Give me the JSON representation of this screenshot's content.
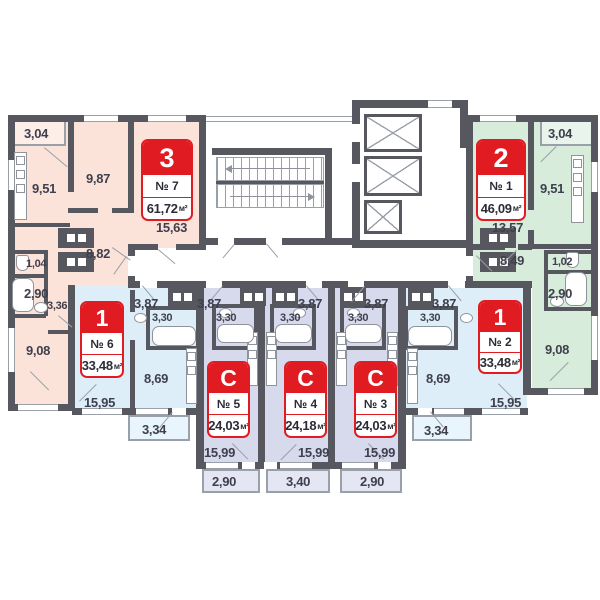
{
  "apartments": {
    "a7": {
      "type": "3",
      "num": "№ 7",
      "area": "61,72",
      "unit": "м²",
      "rooms": {
        "balcony": "3,04",
        "kitchen": "9,51",
        "bed": "9,87",
        "living": "15,63",
        "hall": "8,82",
        "wc": "1,04",
        "bath": "2,90",
        "corr": "3,36",
        "room": "9,08"
      }
    },
    "a6": {
      "type": "1",
      "num": "№ 6",
      "area": "33,48",
      "unit": "м²",
      "rooms": {
        "hall": "3,87",
        "bath": "3,30",
        "kitchen": "8,69",
        "living": "15,95",
        "balcony": "3,34"
      }
    },
    "a5": {
      "type": "С",
      "num": "№ 5",
      "area": "24,03",
      "unit": "м²",
      "rooms": {
        "hall": "3,87",
        "bath": "3,30",
        "living": "15,99",
        "balcony": "2,90"
      }
    },
    "a4": {
      "type": "С",
      "num": "№ 4",
      "area": "24,18",
      "unit": "м²",
      "rooms": {
        "hall": "3,87",
        "bath": "3,30",
        "living": "15,99",
        "balcony": "3,40"
      }
    },
    "a3": {
      "type": "С",
      "num": "№ 3",
      "area": "24,03",
      "unit": "м²",
      "rooms": {
        "hall": "3,87",
        "bath": "3,30",
        "living": "15,99",
        "balcony": "2,90"
      }
    },
    "a2": {
      "type": "1",
      "num": "№ 2",
      "area": "33,48",
      "unit": "м²",
      "rooms": {
        "hall": "3,87",
        "bath": "3,30",
        "kitchen": "8,69",
        "living": "15,95",
        "balcony": "3,34"
      }
    },
    "a1": {
      "type": "2",
      "num": "№ 1",
      "area": "46,09",
      "unit": "м²",
      "rooms": {
        "balcony": "3,04",
        "kitchen": "9,51",
        "living": "13,57",
        "hall": "8,49",
        "wc": "1,02",
        "bath": "2,90",
        "room": "9,08"
      }
    }
  },
  "colors": {
    "wall": "#57575f",
    "red": "#e11b22",
    "peach": "#fbe3da",
    "blue": "#ddeef8",
    "lavender": "#d7d9ec",
    "green": "#d7ecdb"
  }
}
